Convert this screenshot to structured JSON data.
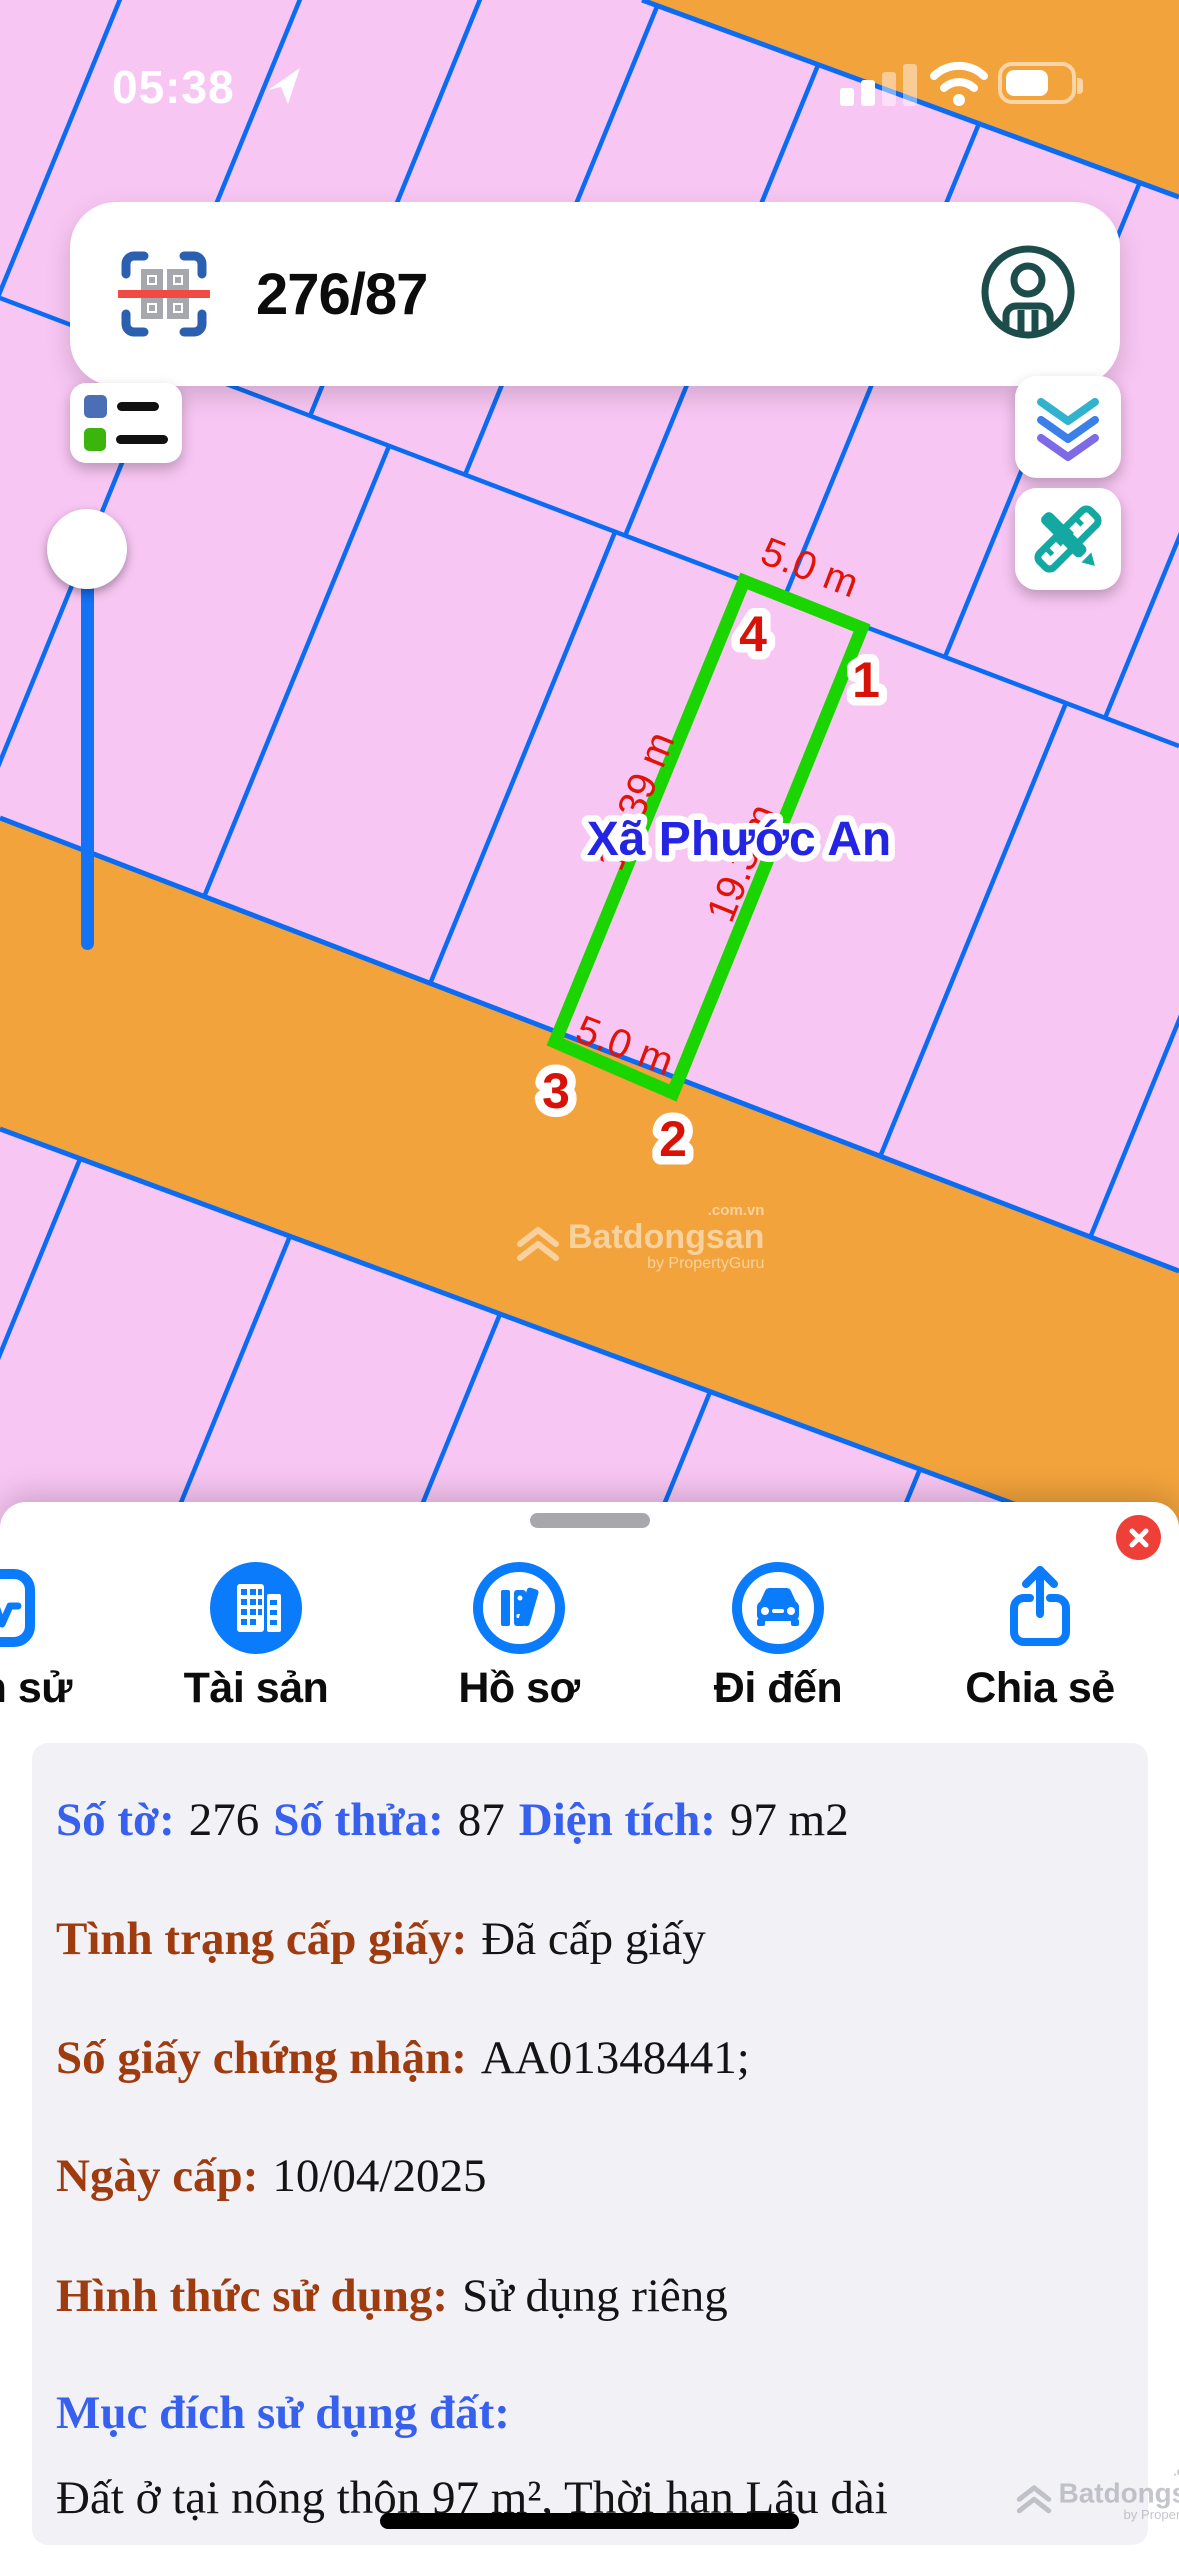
{
  "status_bar": {
    "time": "05:38"
  },
  "search": {
    "query": "276/87"
  },
  "map": {
    "region_label": "Xã Phước An",
    "parcel": {
      "dim_top": "5.0 m",
      "dim_bottom": "5.0 m",
      "dim_left": "19.39 m",
      "dim_right": "19.3 m",
      "corner1": "1",
      "corner2": "2",
      "corner3": "3",
      "corner4": "4"
    },
    "watermark": {
      "brand": "Batdongsan",
      "domain": ".com.vn",
      "byline": "by PropertyGuru"
    }
  },
  "sheet": {
    "tabs": [
      {
        "label": "Lịch sử",
        "icon": "activity-pulse-icon"
      },
      {
        "label": "Tài sản",
        "icon": "buildings-icon"
      },
      {
        "label": "Hồ sơ",
        "icon": "books-icon"
      },
      {
        "label": "Đi đến",
        "icon": "car-icon"
      },
      {
        "label": "Chia sẻ",
        "icon": "share-icon"
      }
    ],
    "info": {
      "line1": {
        "l1": "Số tờ:",
        "v1": "276",
        "l2": "Số thửa:",
        "v2": "87",
        "l3": "Diện tích:",
        "v3": "97 m2"
      },
      "line2": {
        "label": "Tình trạng cấp giấy:",
        "value": "Đã cấp giấy"
      },
      "line3": {
        "label": "Số giấy chứng nhận:",
        "value": "AA01348441;"
      },
      "line4": {
        "label": "Ngày cấp:",
        "value": "10/04/2025"
      },
      "line5": {
        "label": "Hình thức sử dụng:",
        "value": "Sử dụng riêng"
      },
      "line6": {
        "label": "Mục đích sử dụng đất:"
      },
      "line7": {
        "value": "Đất ở tại nông thôn 97 m², Thời hạn Lâu dài"
      }
    }
  },
  "colors": {
    "parcel_pink": "#f8c6f3",
    "road_orange": "#f3a33c",
    "line_blue": "#0b6cf3",
    "parcel_green": "#1ad500",
    "dim_red": "#e11306",
    "region_blue": "#2424e4",
    "accent_blue": "#0a7cfb",
    "close_red": "#ee4038",
    "info_label_blue": "#3760ee",
    "info_label_brown": "#9e3c10"
  }
}
